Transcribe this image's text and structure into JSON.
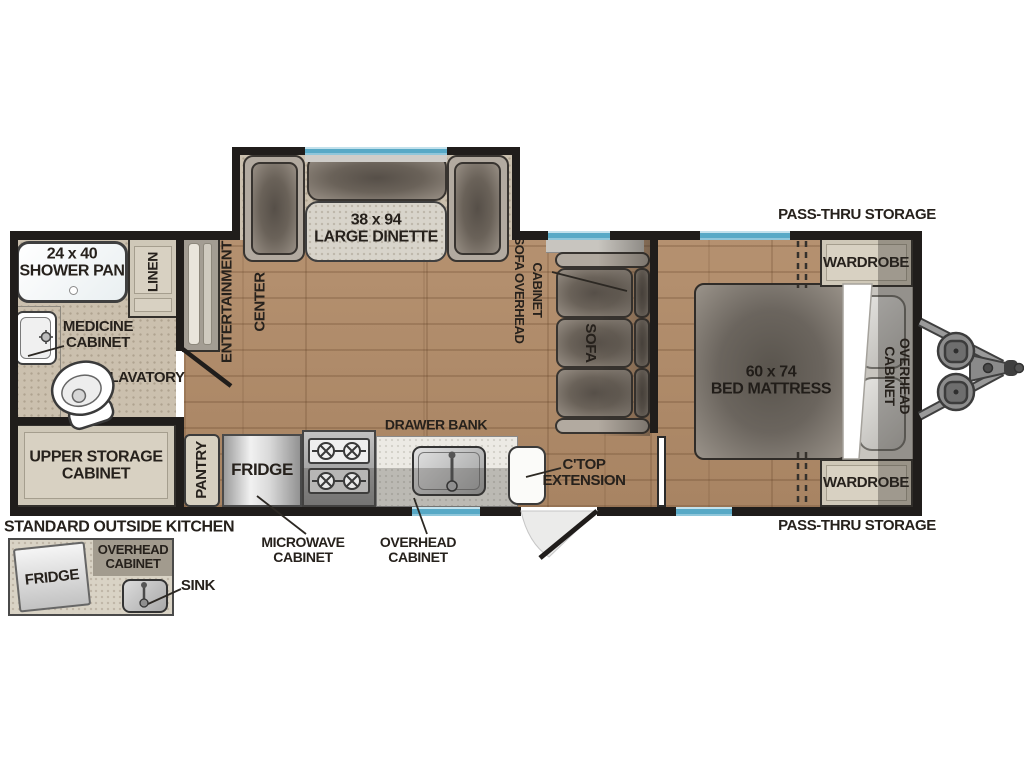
{
  "title": "Travel trailer floor plan",
  "colors": {
    "wall": "#201d1b",
    "wood_floor": "#b18b68",
    "bath_floor": "#cbc0ae",
    "cabinet": "#cfc8b8",
    "window_blue": "#58a9c6",
    "label_text": "#26211c",
    "furniture_gray": "#6a6259",
    "accent_white": "#ffffff"
  },
  "labels": {
    "shower": "24 x 40\nSHOWER PAN",
    "linen": "LINEN",
    "medicine_cabinet": "MEDICINE\nCABINET",
    "lavatory": "LAVATORY",
    "upper_storage": "UPPER STORAGE\nCABINET",
    "entertainment_line1": "ENTERTAINMENT",
    "entertainment_line2": "CENTER",
    "dinette": "38 x 94\nLARGE DINETTE",
    "pantry": "PANTRY",
    "fridge": "FRIDGE",
    "drawer_bank": "DRAWER BANK",
    "microwave_cabinet": "MICROWAVE\nCABINET",
    "overhead_cabinet_kitchen": "OVERHEAD\nCABINET",
    "ctop_extension": "C'TOP\nEXTENSION",
    "sofa": "SOFA",
    "sofa_overhead_line1": "SOFA OVERHEAD",
    "sofa_overhead_line2": "CABINET",
    "bed": "60 x 74\nBED MATTRESS",
    "overhead_cabinet_bedroom": "OVERHEAD CABINET",
    "wardrobe_top": "WARDROBE",
    "wardrobe_bottom": "WARDROBE",
    "pass_thru_top": "PASS-THRU STORAGE",
    "pass_thru_bottom": "PASS-THRU STORAGE",
    "outside_kitchen_title": "STANDARD OUTSIDE KITCHEN",
    "outside_fridge": "FRIDGE",
    "outside_overhead": "OVERHEAD\nCABINET",
    "outside_sink": "SINK"
  }
}
